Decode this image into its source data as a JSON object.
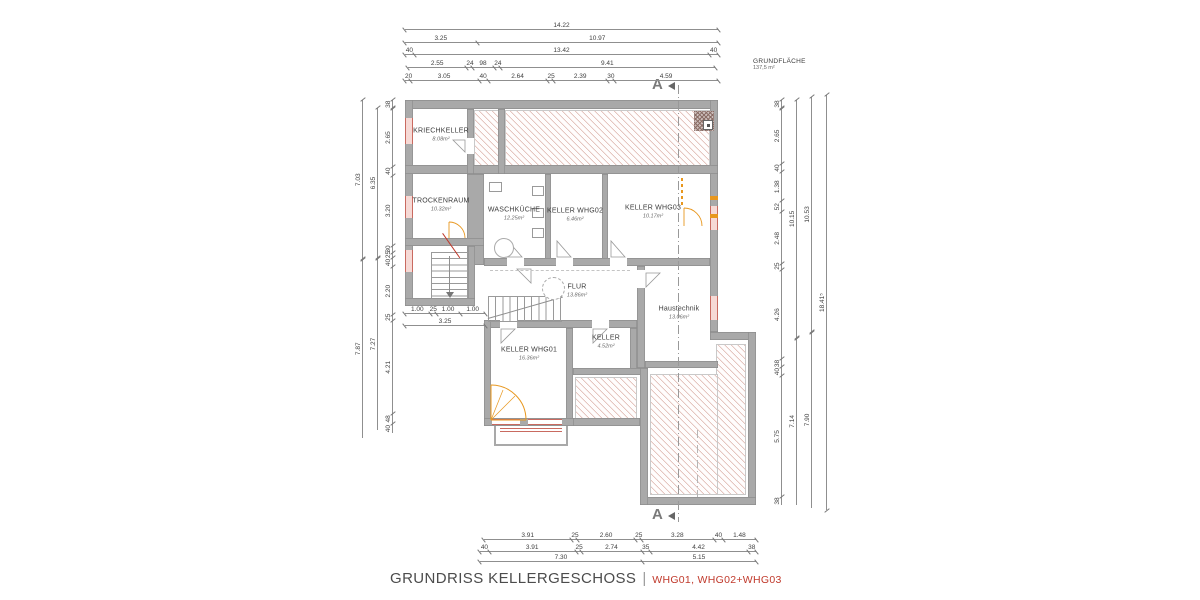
{
  "title": {
    "main": "GRUNDRISS KELLERGESCHOSS",
    "separator": "|",
    "apartments": "WHG01, WHG02+WHG03"
  },
  "legend": {
    "label": "GRUNDFLÄCHE",
    "value": "137,5 m²"
  },
  "section": {
    "label": "A"
  },
  "rooms": [
    {
      "name": "KRIECHKELLER",
      "area": "8.08m²"
    },
    {
      "name": "TROCKENRAUM",
      "area": "10.32m²"
    },
    {
      "name": "WASCHKÜCHE",
      "area": "12.25m²"
    },
    {
      "name": "KELLER WHG02",
      "area": "6.46m²"
    },
    {
      "name": "KELLER WHG03",
      "area": "10.17m²"
    },
    {
      "name": "FLUR",
      "area": "13.86m²"
    },
    {
      "name": "Haustechnik",
      "area": "13.06m²"
    },
    {
      "name": "KELLER",
      "area": "4.52m²"
    },
    {
      "name": "KELLER WHG01",
      "area": "16.36m²"
    }
  ],
  "dimensions": {
    "top": [
      [
        "14.22"
      ],
      [
        "3.25",
        "10.97"
      ],
      [
        "40",
        "13.42",
        "40"
      ],
      [
        "2.55",
        "24",
        "98",
        "24",
        "9.41"
      ],
      [
        "20",
        "3.05",
        "40",
        "2.64",
        "25",
        "2.39",
        "30",
        "4.59"
      ]
    ],
    "bottom": [
      [
        "3.91",
        "25",
        "2.60",
        "25",
        "3.28",
        "40",
        "1.48"
      ],
      [
        "40",
        "3.91",
        "25",
        "2.74",
        "35",
        "4.42",
        "38"
      ],
      [
        "7.30",
        "5.15"
      ]
    ],
    "left": {
      "inner": [
        "38",
        "2.65",
        "40",
        "3.20",
        "30",
        "25",
        "40",
        "2.20",
        "25",
        "4.21",
        "48",
        "40"
      ],
      "mid": [
        "6.35",
        "7.27"
      ],
      "outer": [
        "7.03",
        "7.87"
      ]
    },
    "right": {
      "inner": [
        "38",
        "2.65",
        "40",
        "1.38",
        "52",
        "2.48",
        "25",
        "4.26",
        "38",
        "40",
        "5.75",
        "38"
      ],
      "mid": [
        "10.15",
        "7.14"
      ],
      "outer": [
        "10.53",
        "7.90"
      ],
      "total": [
        "18.41⁵"
      ]
    },
    "stair": [
      [
        "1.00",
        "25",
        "1.00",
        "1.00"
      ],
      [
        "3.25"
      ]
    ]
  }
}
